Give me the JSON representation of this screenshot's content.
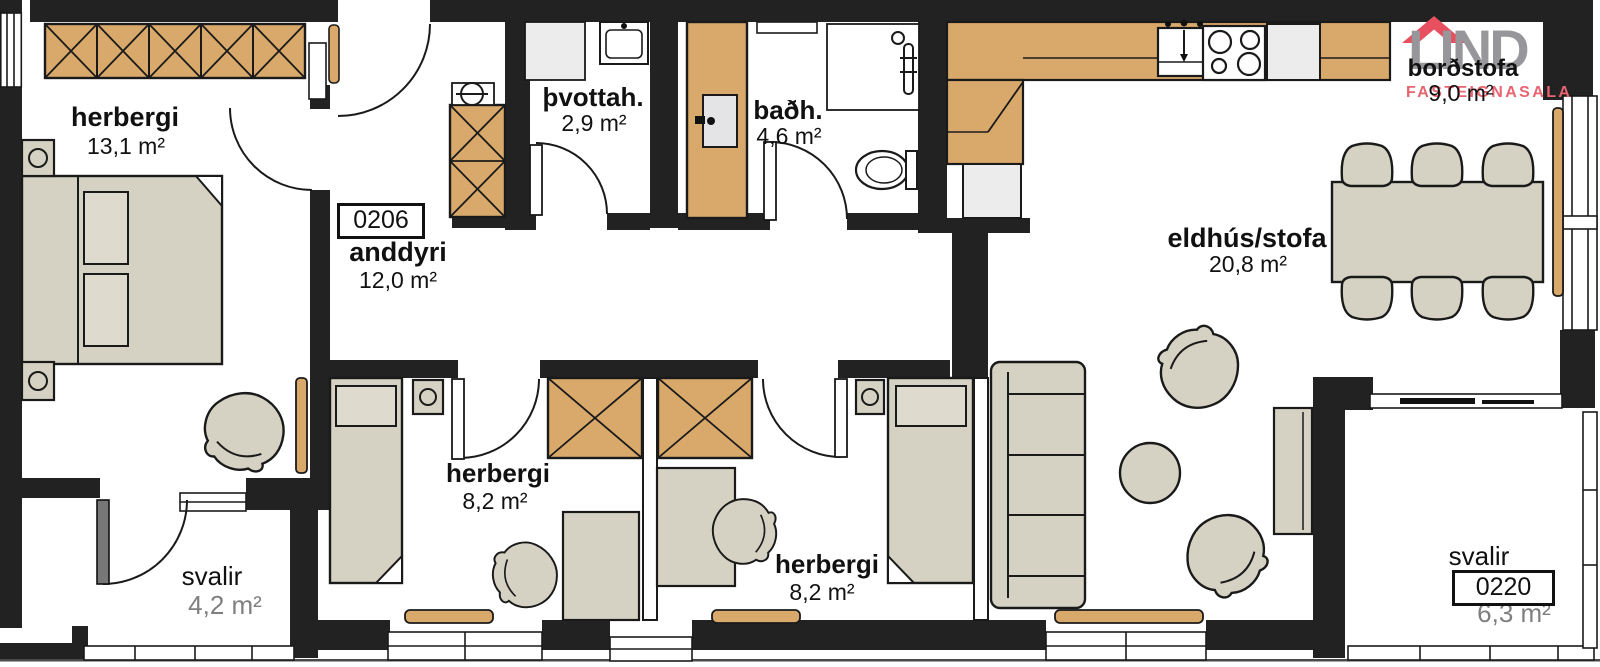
{
  "logo": {
    "brand": "LIND",
    "subtitle": "FASTEIGNASALA"
  },
  "units": {
    "entry_number": "0206",
    "balcony_number": "0220"
  },
  "rooms": {
    "bedroom_main": {
      "name": "herbergi",
      "area": "13,1 m²"
    },
    "entry": {
      "name": "anddyri",
      "area": "12,0 m²"
    },
    "laundry": {
      "name": "þvottah.",
      "area": "2,9 m²"
    },
    "bathroom": {
      "name": "baðh.",
      "area": "4,6 m²"
    },
    "kitchen_living": {
      "name": "eldhús/stofa",
      "area": "20,8 m²"
    },
    "dining": {
      "name": "borðstofa",
      "area": "9,0 m²"
    },
    "bedroom_two": {
      "name": "herbergi",
      "area": "8,2 m²"
    },
    "bedroom_three": {
      "name": "herbergi",
      "area": "8,2 m²"
    },
    "balcony_left": {
      "name": "svalir",
      "area": "4,2 m²"
    },
    "balcony_right": {
      "name": "svalir",
      "area": "6,3 m²"
    }
  },
  "colors": {
    "wall": "#222222",
    "wood": "#d9a96b",
    "furniture": "#d6d2c3",
    "appliance": "#ececec",
    "logo_gray": "#97969b",
    "logo_red": "#e8505f",
    "logo_sub_red": "#e86470",
    "muted_text": "#7f7f7f",
    "text": "#111111"
  }
}
